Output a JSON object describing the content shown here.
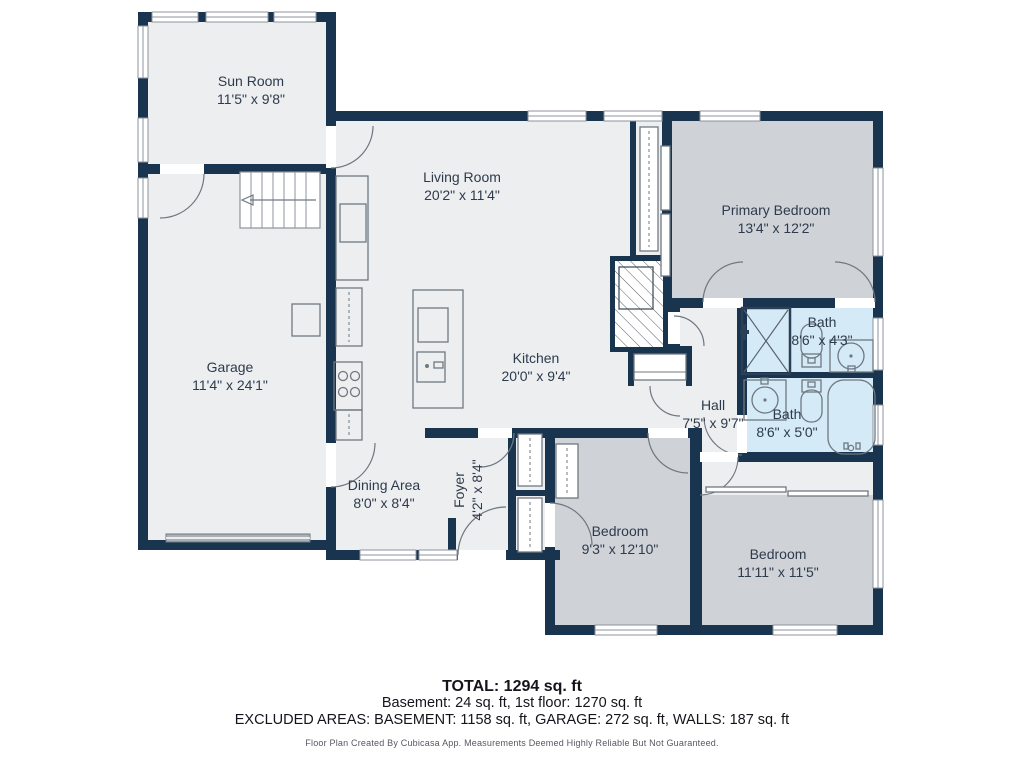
{
  "rooms": [
    {
      "id": "sun-room",
      "name": "Sun Room",
      "dims": "11'5\" x 9'8\""
    },
    {
      "id": "living-room",
      "name": "Living Room",
      "dims": "20'2\" x 11'4\""
    },
    {
      "id": "primary-bedroom",
      "name": "Primary Bedroom",
      "dims": "13'4\" x 12'2\""
    },
    {
      "id": "garage",
      "name": "Garage",
      "dims": "11'4\" x 24'1\""
    },
    {
      "id": "kitchen",
      "name": "Kitchen",
      "dims": "20'0\" x 9'4\""
    },
    {
      "id": "bath-ensuite",
      "name": "Bath",
      "dims": "8'6\" x 4'3\""
    },
    {
      "id": "hall",
      "name": "Hall",
      "dims": "7'5\" x 9'7\""
    },
    {
      "id": "bath-hall",
      "name": "Bath",
      "dims": "8'6\" x 5'0\""
    },
    {
      "id": "dining-area",
      "name": "Dining Area",
      "dims": "8'0\" x 8'4\""
    },
    {
      "id": "foyer",
      "name": "Foyer",
      "dims": "4'2\" x 8'4\""
    },
    {
      "id": "bedroom-left",
      "name": "Bedroom",
      "dims": "9'3\" x 12'10\""
    },
    {
      "id": "bedroom-right",
      "name": "Bedroom",
      "dims": "11'11\" x 11'5\""
    }
  ],
  "summary": {
    "total_label": "TOTAL: 1294 sq. ft",
    "floors_line": "Basement: 24 sq. ft, 1st floor: 1270 sq. ft",
    "excluded_line": "EXCLUDED AREAS: BASEMENT: 1158 sq. ft, GARAGE: 272 sq. ft, WALLS: 187 sq. ft",
    "disclaimer": "Floor Plan Created By Cubicasa App. Measurements Deemed Highly Reliable But Not Guaranteed."
  },
  "colors": {
    "wall": "#18344F",
    "floor": "#EDEEEF",
    "bedroom_fill": "#CFD2D6",
    "bath_fill": "#D4EAF6"
  }
}
